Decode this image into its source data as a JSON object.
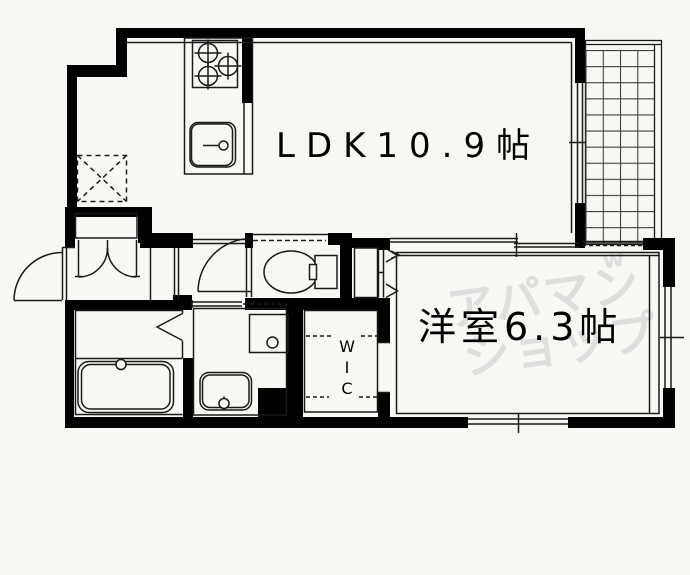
{
  "palette": {
    "background": "#f7f7f3",
    "wall": "#000000",
    "line": "#1a1a1a",
    "grid_line": "#3c3c3c",
    "text": "#000000",
    "watermark": "#dedede"
  },
  "floorplan": {
    "rooms": {
      "ldk": {
        "label": "LDK10.9帖"
      },
      "western_room": {
        "label": "洋室6.3帖"
      },
      "wic": {
        "letters": [
          "W",
          "I",
          "C"
        ]
      }
    },
    "watermark": {
      "line1": "アパマン",
      "line2": "ショップ",
      "mark": "w"
    },
    "fixtures": [
      "stove-burners",
      "kitchen-sink",
      "refrigerator-space",
      "shoe-cabinet",
      "entrance-door",
      "toilet",
      "toilet-door",
      "bathtub",
      "bathroom-door",
      "washbasin",
      "washing-machine-pan",
      "closet-doors",
      "wic-doorway",
      "sliding-door",
      "balcony-grid",
      "window-ldk",
      "window-south",
      "window-east"
    ]
  }
}
